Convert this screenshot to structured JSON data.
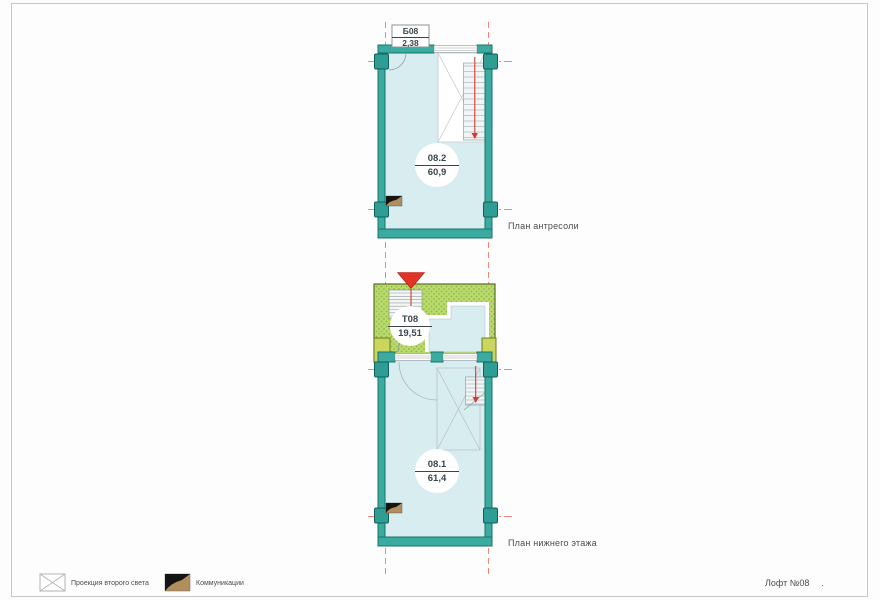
{
  "sheet": {
    "title": "Лофт №08",
    "title_dot": ".",
    "colors": {
      "wall_teal": "#3bab9f",
      "wall_teal_dark": "#17736c",
      "room_fill": "#d8edf0",
      "terrace_green": "#b9da6d",
      "terrace_dot_green": "#8fb741",
      "pilaster_yellow": "#c9d75f",
      "axis_red": "#f3867a",
      "entry_marker_red": "#e23425",
      "communications_tan": "#b38e5d"
    }
  },
  "mezzanine_plan": {
    "caption": "План антресоли",
    "balcony": {
      "code": "Б08",
      "area": "2,38"
    },
    "room": {
      "number": "08.2",
      "area": "60,9"
    }
  },
  "lower_plan": {
    "caption": "План нижнего этажа",
    "terrace": {
      "code": "Т08",
      "area": "19,51"
    },
    "room": {
      "number": "08.1",
      "area": "61,4"
    }
  },
  "legend": {
    "second_light": "Проекция второго света",
    "communications": "Коммуникации"
  }
}
